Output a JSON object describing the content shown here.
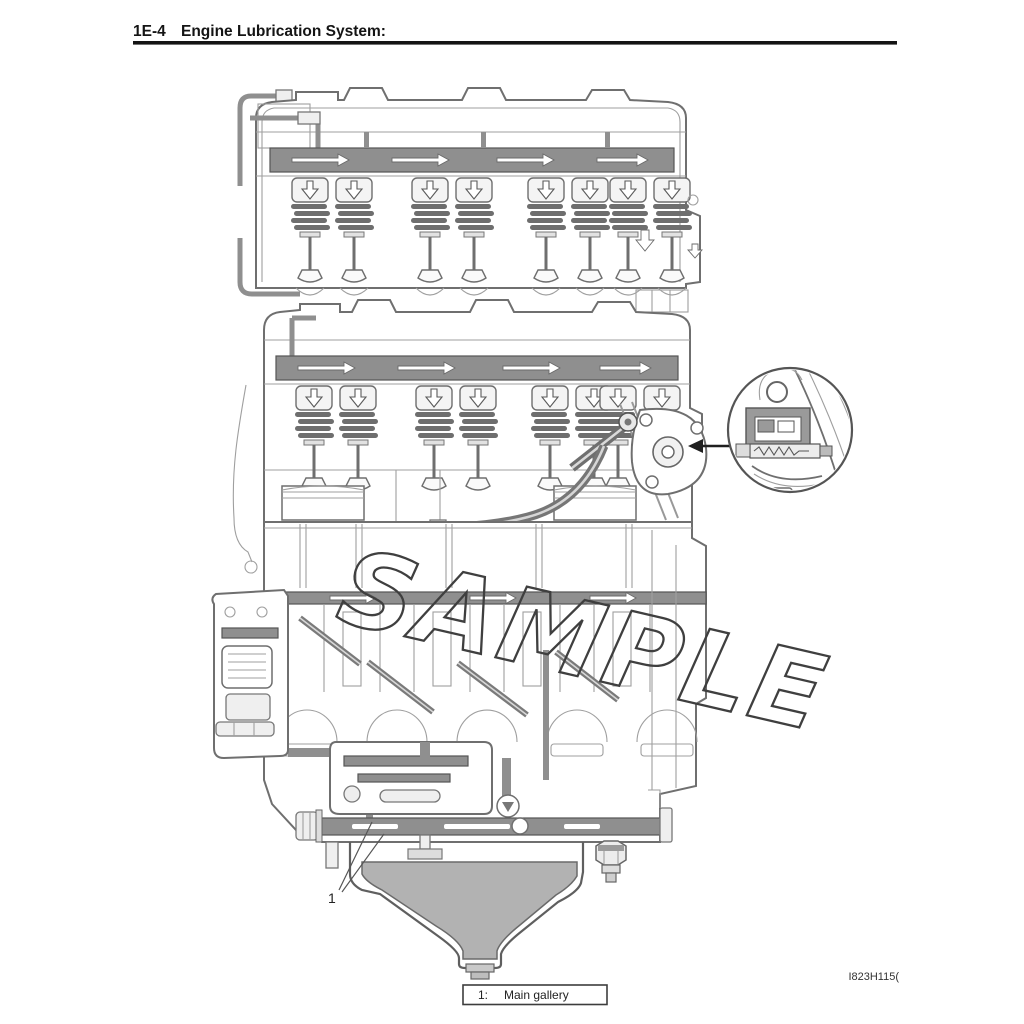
{
  "header": {
    "section_number": "1E-4",
    "section_title": "Engine Lubrication System:"
  },
  "figure": {
    "watermark_text": "SAMPLE",
    "code": "I823H115(",
    "callout_1": "1",
    "caption": {
      "index": "1:",
      "label": "Main gallery"
    },
    "colors": {
      "line": "#6f6f6f",
      "oil_passage": "#8f8f8f",
      "oil_fill": "#b2b2b2",
      "watermark_outline": "#3f3f3f",
      "ink": "#141414"
    }
  }
}
